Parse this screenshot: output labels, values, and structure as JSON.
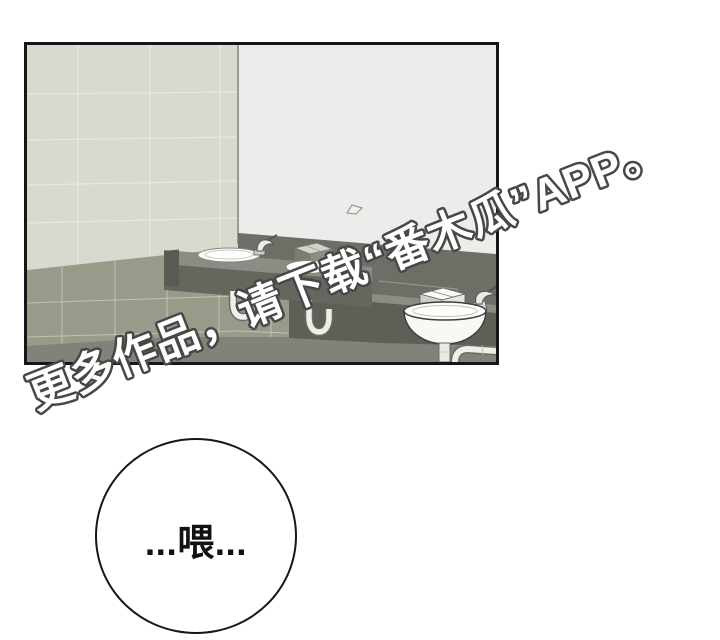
{
  "watermark": {
    "text": "更多作品，请下载“番木瓜”APP。",
    "fill": "#ffffff",
    "outline": "#474747"
  },
  "speech_bubble": {
    "text": "...喂..."
  },
  "panel": {
    "scene": "bathroom-with-sinks",
    "colors": {
      "panel_border": "#161616",
      "mirror_wall": "#ececea",
      "tile_wall": "#d9d9cf",
      "tile_grout": "#e8e8de",
      "wall_corner": "#9b9b93",
      "lower_wall": "#9a9a8a",
      "lower_grout": "#c6c6b8",
      "floor": "#82827a",
      "backsplash": "#6e6e67",
      "counter_top": "#8c8c84",
      "counter_front": "#66665f",
      "counter_apron": "#5f5f58",
      "fixture_white": "#fdfdfb",
      "pipe_outline": "#6a6a63",
      "pipe_fill": "#efefea"
    }
  }
}
